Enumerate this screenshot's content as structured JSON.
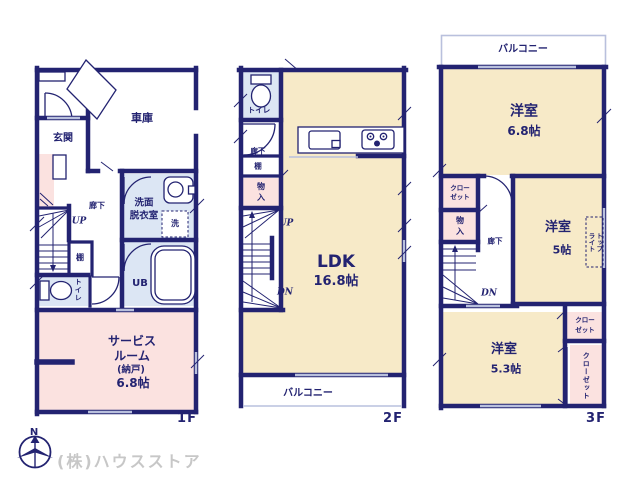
{
  "colors": {
    "wall": "#232371",
    "cream": "#f7eac8",
    "pink": "#fbe2e0",
    "wet": "#dce6f4",
    "wgray": "#b9c0dd",
    "watermark": "#c7c7c7"
  },
  "compass": {
    "north": "N"
  },
  "watermark": "(株)ハウスストア",
  "floor1": {
    "floor_label": "1F",
    "garage": "車庫",
    "entrance": "玄関",
    "hallway": "廊下",
    "stairs_up": "UP",
    "shelf": "棚",
    "toilet": "トイレ",
    "washroom_l1": "洗面",
    "washroom_l2": "脱衣室",
    "washer": "洗",
    "bath": "UB",
    "service_l1": "サービス",
    "service_l2": "ルーム",
    "service_l3": "(納戸)",
    "service_l4": "6.8帖"
  },
  "floor2": {
    "floor_label": "2F",
    "toilet": "トイレ",
    "hallway": "廊下",
    "shelf": "棚",
    "storage_l1": "物",
    "storage_l2": "入",
    "stairs_up": "UP",
    "stairs_down": "DN",
    "ldk_l1": "LDK",
    "ldk_l2": "16.8帖",
    "balcony": "バルコニー"
  },
  "floor3": {
    "floor_label": "3F",
    "balcony": "バルコニー",
    "room1_l1": "洋室",
    "room1_l2": "6.8帖",
    "closet1_l1": "クロー",
    "closet1_l2": "ゼット",
    "storage_l1": "物",
    "storage_l2": "入",
    "hallway": "廊下",
    "stairs_down": "DN",
    "room2_l1": "洋室",
    "room2_l2": "5帖",
    "skylight": "トップ\nライト",
    "closet2_l1": "クロー",
    "closet2_l2": "ゼット",
    "closet3": "クローゼット",
    "room3_l1": "洋室",
    "room3_l2": "5.3帖"
  }
}
